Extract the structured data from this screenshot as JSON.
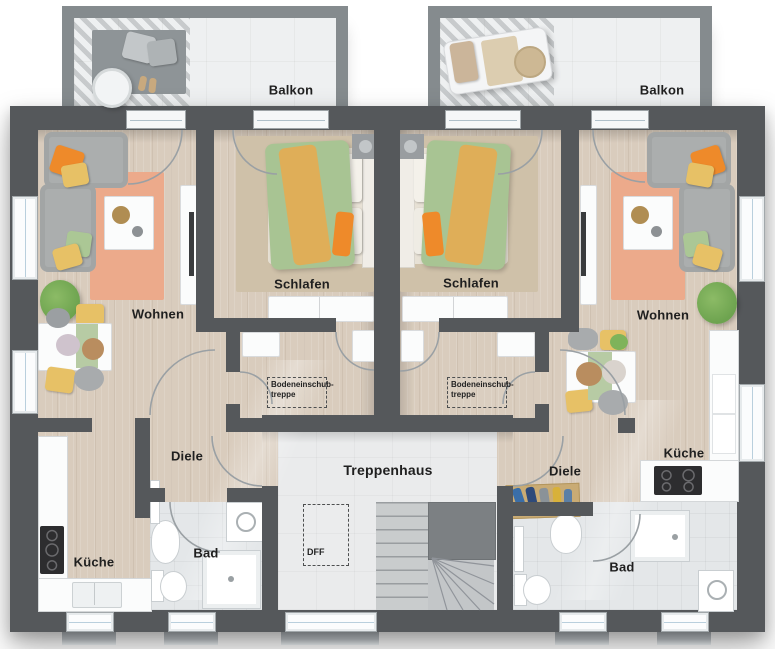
{
  "labels": {
    "balkon_left": "Balkon",
    "balkon_right": "Balkon",
    "wohnen_left": "Wohnen",
    "schlafen_left": "Schlafen",
    "kueche_left": "Küche",
    "bad_left": "Bad",
    "diele_left": "Diele",
    "wohnen_right": "Wohnen",
    "schlafen_right": "Schlafen",
    "kueche_right": "Küche",
    "bad_right": "Bad",
    "diele_right": "Diele",
    "treppenhaus": "Treppenhaus",
    "dff": "DFF",
    "attic_line1": "Bodeneinschub-",
    "attic_line2": "treppe"
  },
  "palette": {
    "wall": "#55585b",
    "floor-wood": "#d9ccbd",
    "bath-floor": "#e4e7e9",
    "stair-floor": "#eaebec",
    "balcony-floor": "#eef0f1",
    "rail": "#858b8e",
    "rug-salmon": "#ecaa8b",
    "rug-bedroom": "#cfc1a9",
    "sofa-gray": "#abaeae",
    "accent-orange": "#ee8a2a",
    "accent-yellow": "#e7c166",
    "accent-green": "#abc795",
    "duvet-green": "#a8c493",
    "duvet-stripe": "#dfae58",
    "plant-green": "#6da34f",
    "cooktop": "#2d2d2f",
    "label-color": "#1f1f1f",
    "arc-color": "#9aa0a4",
    "white-furniture": "#fbfcfc"
  }
}
